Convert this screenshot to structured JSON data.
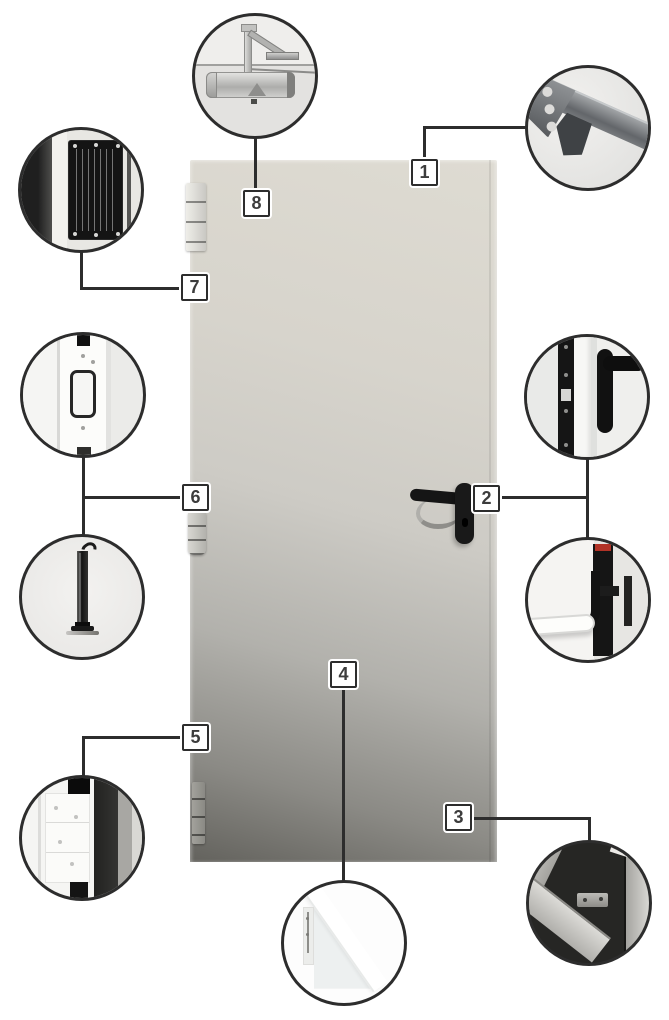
{
  "figure": {
    "type": "product-callout-diagram",
    "subject": "steel-door-with-hardware-details"
  },
  "colors": {
    "background": "#ffffff",
    "connector_line": "#2d2d2d",
    "callout_box_bg": "#ffffff",
    "callout_box_border": "#2d2d2d",
    "callout_number_text": "#3c3c3c",
    "door_top": "#dedbd2",
    "door_bottom": "#63625d",
    "handle_black": "#151515",
    "panic_bar_red_accent": "#b23327"
  },
  "callouts": [
    {
      "label": "1",
      "detail": "frame-corner-bracket"
    },
    {
      "label": "2",
      "detail": "lever-handle-and-panic-bar"
    },
    {
      "label": "3",
      "detail": "frame-threshold-corner"
    },
    {
      "label": "4",
      "detail": "door-leaf-corner-section"
    },
    {
      "label": "5",
      "detail": "hinge"
    },
    {
      "label": "6",
      "detail": "strike-plate-and-flush-bolt-rod"
    },
    {
      "label": "7",
      "detail": "rating-plate"
    },
    {
      "label": "8",
      "detail": "door-closer"
    }
  ]
}
